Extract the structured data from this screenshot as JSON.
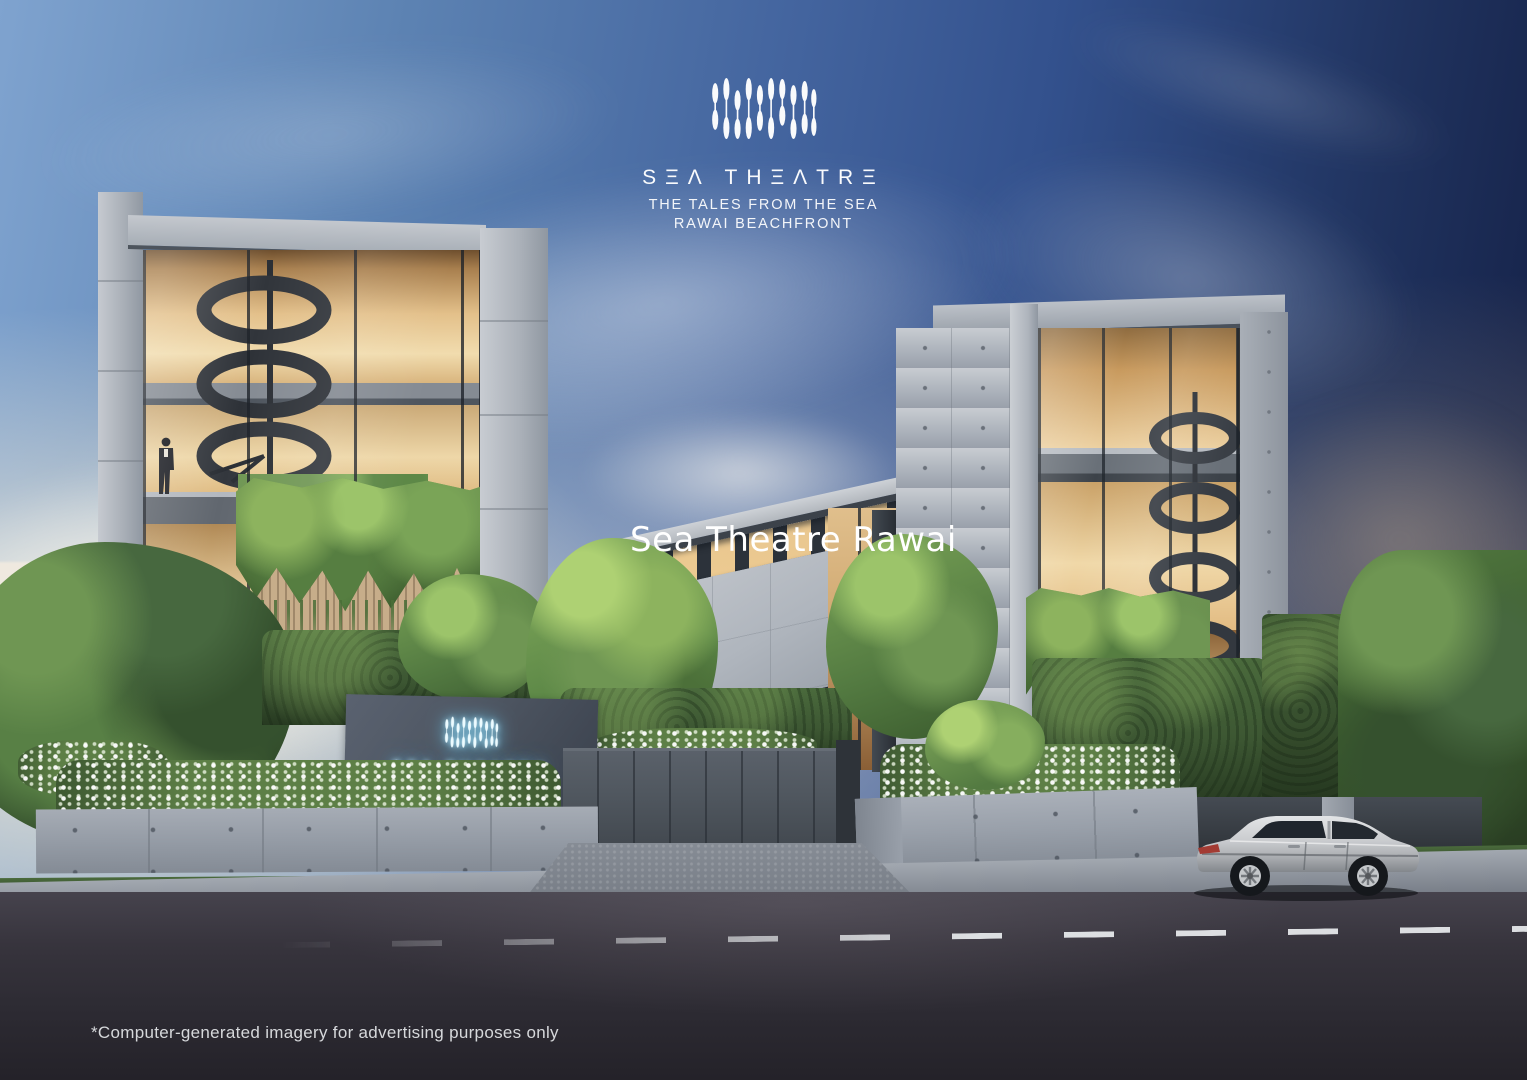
{
  "branding": {
    "logo_icon": "paddle-oars-logo-icon",
    "wordmark": "SΞΛ THΞΛTRΞ",
    "tagline_line1": "THE TALES FROM THE SEA",
    "tagline_line2": "RAWAI BEACHFRONT"
  },
  "watermark": {
    "text": "Sea Theatre Rawai"
  },
  "entrance_sign": {
    "icon": "neon-paddle-oars-icon",
    "wordmark": "SΞΛ THΞΛTRΞ"
  },
  "disclaimer": {
    "text": "*Computer-generated imagery for advertising purposes only"
  },
  "colors": {
    "sky-deep": "#111b3f",
    "sky-mid": "#33518d",
    "sky-light": "#7fa3cf",
    "sun-glow": "#fff4dc",
    "concrete": "#aeb4bc",
    "concrete-shadow": "#848b95",
    "interior-warm": "#ecd2a2",
    "interior-amber": "#c99b5e",
    "wood-slat": "#c7ad8a",
    "foliage-bright": "#a6cc70",
    "foliage-mid": "#5d8847",
    "foliage-dark": "#2b4226",
    "hedge": "#3c5632",
    "sign-wall": "#4e5662",
    "neon": "#ecfbff",
    "neon-glow": "#66c6ec",
    "gate": "#50575f",
    "wall-light": "#98a0aa",
    "road": "#37343d",
    "sidewalk": "#8e949d",
    "car-silver": "#c9cbcd"
  }
}
